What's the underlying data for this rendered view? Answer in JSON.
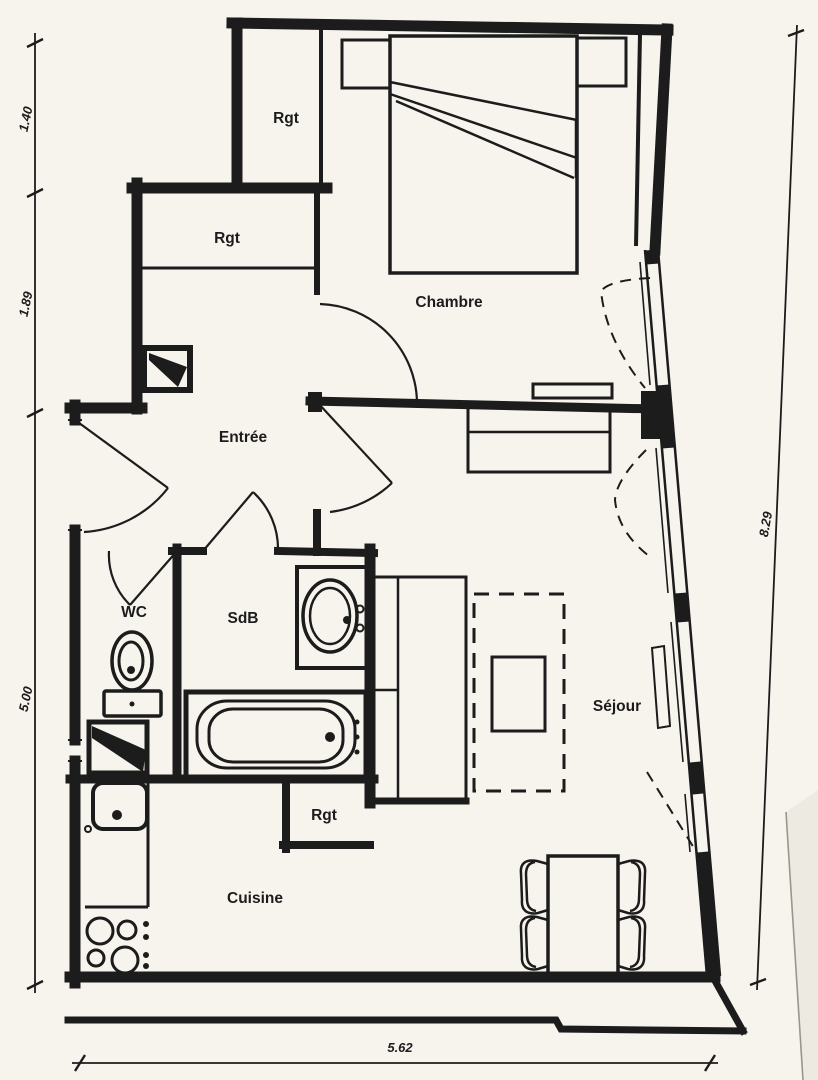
{
  "colors": {
    "ink": "#1c1c1c",
    "paper": "#f7f4ee",
    "page_edge": "#9a968e",
    "page_shadow": "#edeae2"
  },
  "rooms": {
    "rgt_top": {
      "label": "Rgt"
    },
    "rgt_middle": {
      "label": "Rgt"
    },
    "chambre": {
      "label": "Chambre"
    },
    "entree": {
      "label": "Entrée"
    },
    "wc": {
      "label": "WC"
    },
    "sdb": {
      "label": "SdB"
    },
    "sejour": {
      "label": "Séjour"
    },
    "rgt_bottom": {
      "label": "Rgt"
    },
    "cuisine": {
      "label": "Cuisine"
    }
  },
  "dimensions_m": {
    "left_top": "1.40",
    "left_middle": "1.89",
    "left_bottom": "5.00",
    "right_side": "8.29",
    "bottom": "5.62"
  }
}
